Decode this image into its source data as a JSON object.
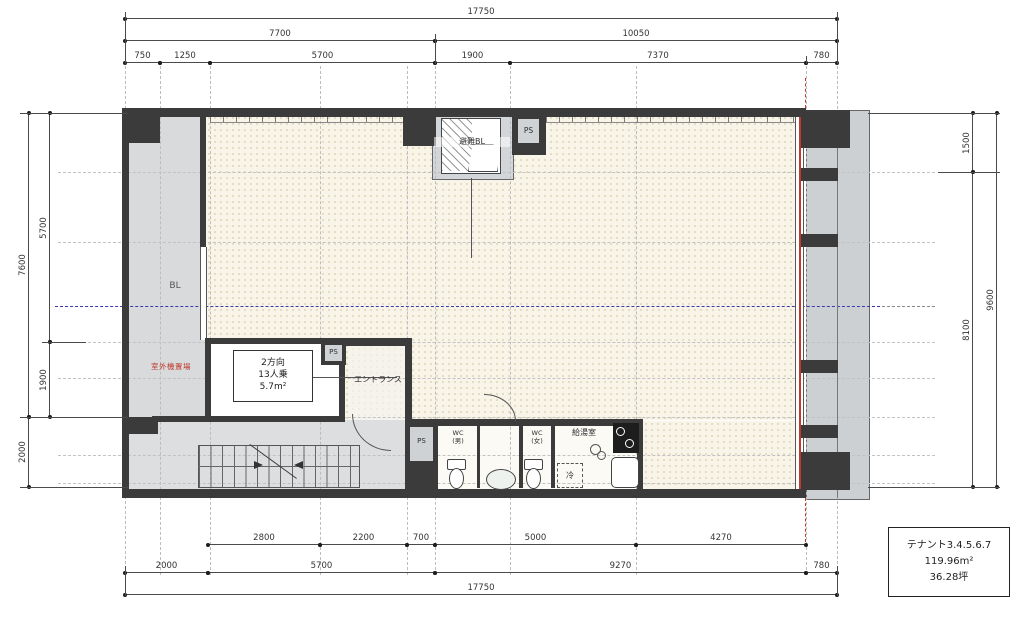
{
  "dims": {
    "top": {
      "r1": [
        "17750"
      ],
      "r2": [
        "7700",
        "10050"
      ],
      "r3": [
        "750",
        "1250",
        "5700",
        "1900",
        "7370",
        "780"
      ]
    },
    "bottom": {
      "r1": [
        "2800",
        "2200",
        "700",
        "5000",
        "4270"
      ],
      "r2": [
        "2000",
        "5700",
        "9270",
        "780"
      ],
      "r3": [
        "17750"
      ]
    },
    "left": {
      "outer": [
        "7600",
        "2000"
      ],
      "inner": [
        "5700",
        "1900"
      ]
    },
    "right": {
      "inner": [
        "1500",
        "8100"
      ],
      "outer": [
        "9600"
      ]
    }
  },
  "rooms": {
    "balcony": "BL",
    "outdoor_unit_area": "室外機置場",
    "evacuation_hatch": "避難BL",
    "pipe_shaft": "PS",
    "elevator": {
      "l1": "2方向",
      "l2": "13人乗",
      "l3": "5.7m²"
    },
    "entrance": "エントランス",
    "wc_male": {
      "l1": "WC",
      "l2": "(男)"
    },
    "wc_female": {
      "l1": "WC",
      "l2": "(女)"
    },
    "kitchenette": "給湯室",
    "refrigerator": "冷"
  },
  "note": {
    "tenant": "テナント3.4.5.6.7",
    "area_m2": "119.96m²",
    "area_tsubo": "36.28坪"
  },
  "colors": {
    "wall": "#3b3b3b",
    "tenant_fill": "#f8f4e7",
    "balcony_fill": "#d6d9da",
    "centerline_blue": "#3a3aae",
    "highlight_red": "#c0392b"
  }
}
